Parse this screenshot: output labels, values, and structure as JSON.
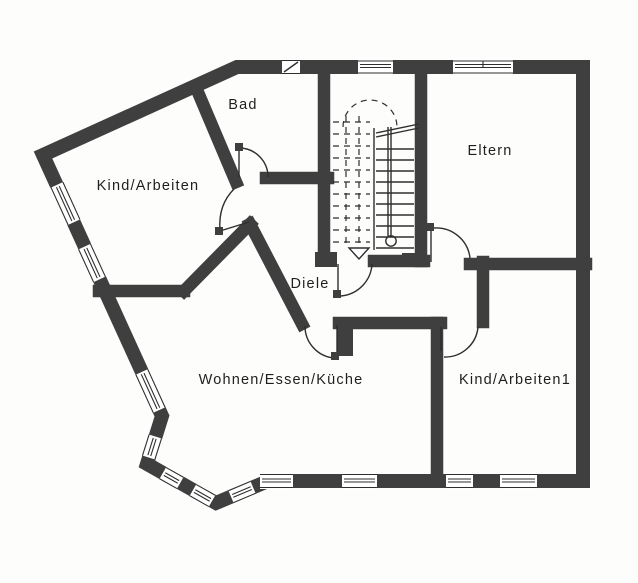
{
  "document": {
    "type": "architectural-floor-plan",
    "floor_note": "upper floor apartment plan with central stairwell"
  },
  "colors": {
    "wall": "#3f3f3f",
    "line": "#2e2e2e",
    "text": "#1f1f1f",
    "paper": "#fdfdfc"
  },
  "rooms": [
    {
      "id": "kind-arbeiten",
      "label": "Kind/Arbeiten"
    },
    {
      "id": "bad",
      "label": "Bad"
    },
    {
      "id": "eltern",
      "label": "Eltern"
    },
    {
      "id": "diele",
      "label": "Diele"
    },
    {
      "id": "wohnen-essen-kueche",
      "label": "Wohnen/Essen/Küche"
    },
    {
      "id": "kind-arbeiten1",
      "label": "Kind/Arbeiten1"
    }
  ],
  "stairs": {
    "direction_marker": "down-triangle",
    "upper_flight_style": "dashed",
    "lower_flight_style": "solid"
  },
  "counts": {
    "doors": 6,
    "windows": 11
  }
}
